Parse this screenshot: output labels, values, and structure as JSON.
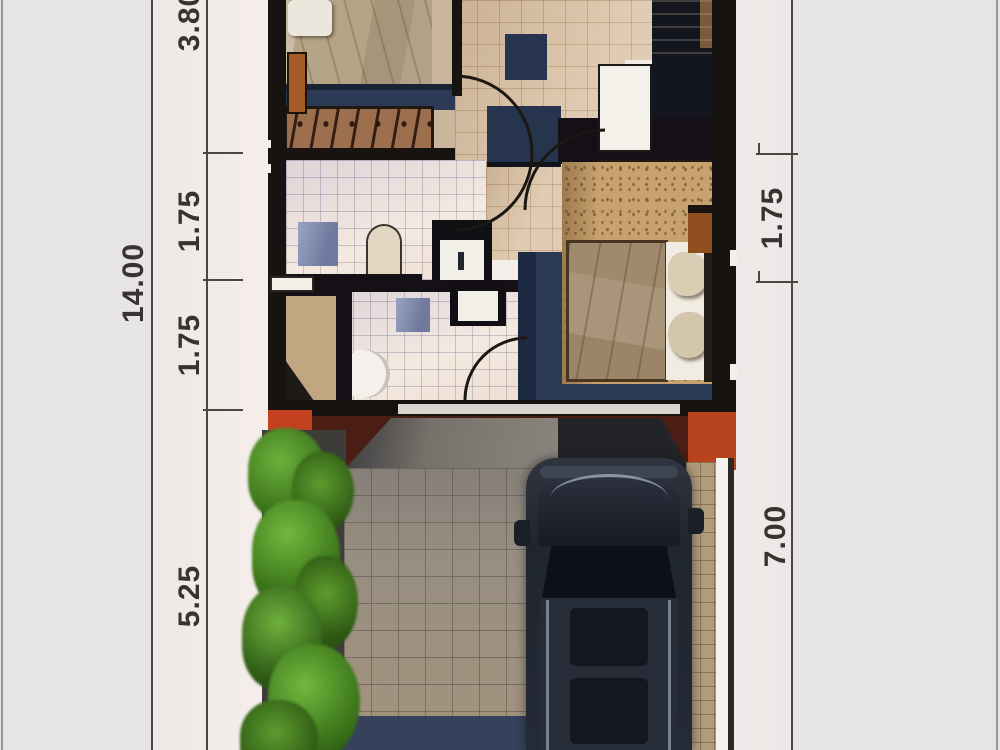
{
  "document": {
    "type": "architectural floor plan, top-view 3D render",
    "units": "meters"
  },
  "dimensions": {
    "left_total": "14.00",
    "left_segments": [
      "3.80",
      "1.75",
      "1.75",
      "5.25"
    ],
    "right_segments": [
      "1.75",
      "7.00"
    ]
  },
  "colors": {
    "background": "#e7e4e5",
    "paper_center": "#f4ede9",
    "dimension_line": "#4b4641",
    "dimension_text": "#383330",
    "wall_black": "#171310",
    "wall_navy": "#2b3a55",
    "tile_beige": "#dcc5a8",
    "tile_bath": "#f0e8e0",
    "wardrobe_brown": "#9c6f4e",
    "terrace_maroon": "#4a1d15",
    "terrace_red": "#c3411e",
    "paving_gray": "#928c84",
    "paving_tan": "#b19b7b",
    "plant_green": "#4c7f22",
    "car_body": "#242a36"
  },
  "icons": {
    "bed": "bed-icon",
    "wardrobe_hangers": "wardrobe-hangers-icon",
    "stairs": "stairs-icon",
    "door_swing": "door-swing-icon",
    "toilet": "toilet-icon",
    "sink": "sink-icon",
    "shower": "shower-icon",
    "car": "car-icon",
    "shrubs": "shrub-icon"
  }
}
